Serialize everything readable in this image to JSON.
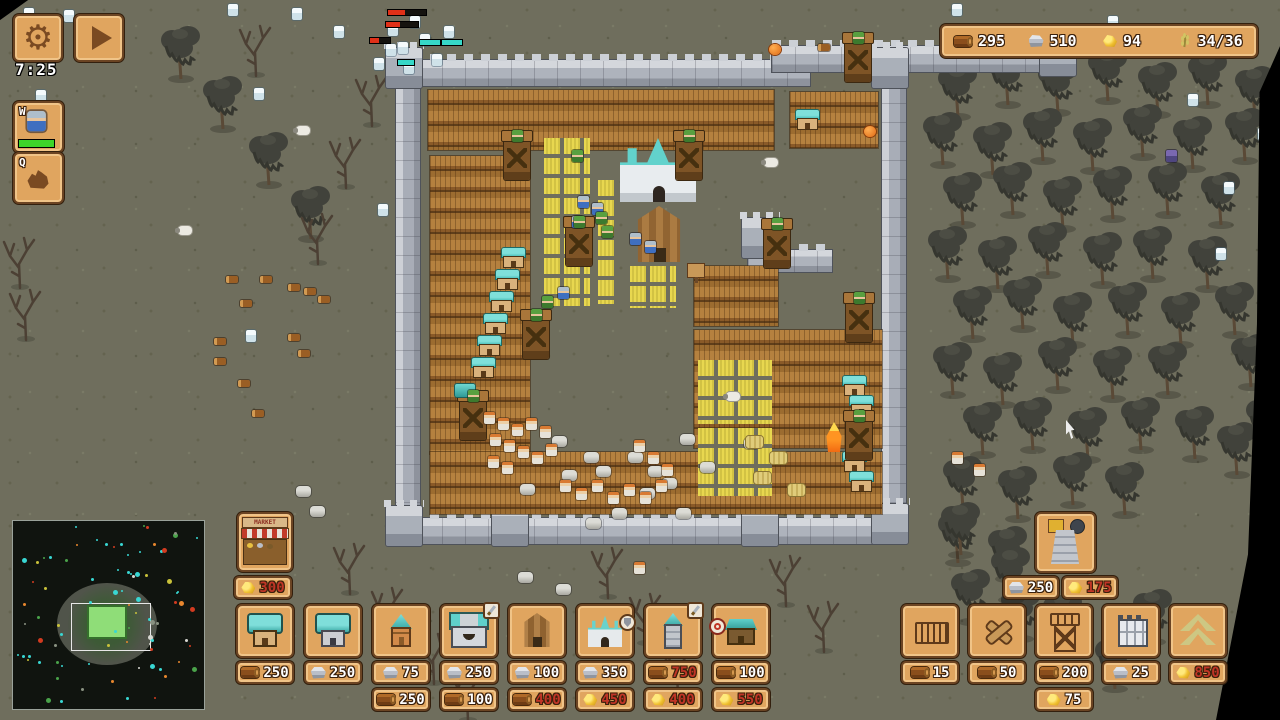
{
  "hud": {
    "timer": "7:25",
    "abilities": [
      {
        "key": "W"
      },
      {
        "key": "Q"
      }
    ],
    "resources": [
      {
        "name": "wood",
        "value": "295"
      },
      {
        "name": "stone",
        "value": "510"
      },
      {
        "name": "gold",
        "value": "94"
      },
      {
        "name": "food",
        "value": "34/36"
      }
    ],
    "colors": {
      "panel": "#e0a55f",
      "panel_border": "#6b4423",
      "cost_ok": "#ffffff",
      "cost_no": "#c03526",
      "hp_green": "#3ed52a",
      "hp_red": "#e03018",
      "hp_teal": "#36d8c8"
    }
  },
  "build": {
    "market": {
      "label": "MARKET",
      "costs": [
        {
          "res": "gold",
          "value": "300",
          "ok": false
        }
      ]
    },
    "tower_costs": [
      {
        "res": "stone",
        "value": "250",
        "ok": true
      },
      {
        "res": "gold",
        "value": "175",
        "ok": false
      }
    ],
    "left": [
      {
        "icon": "house-wood",
        "costs": [
          {
            "res": "wood",
            "value": "250",
            "ok": true
          }
        ]
      },
      {
        "icon": "house-stone",
        "costs": [
          {
            "res": "stone",
            "value": "250",
            "ok": true
          }
        ]
      },
      {
        "icon": "house-small",
        "costs": [
          {
            "res": "stone",
            "value": "75",
            "ok": true
          },
          {
            "res": "wood",
            "value": "250",
            "ok": true
          }
        ]
      },
      {
        "icon": "castle",
        "badge": "sword",
        "costs": [
          {
            "res": "stone",
            "value": "250",
            "ok": true
          },
          {
            "res": "wood",
            "value": "100",
            "ok": true
          }
        ]
      },
      {
        "icon": "barn",
        "costs": [
          {
            "res": "stone",
            "value": "100",
            "ok": true
          },
          {
            "res": "wood",
            "value": "400",
            "ok": false
          }
        ]
      },
      {
        "icon": "church",
        "badge": "shield",
        "costs": [
          {
            "res": "stone",
            "value": "350",
            "ok": true
          },
          {
            "res": "gold",
            "value": "450",
            "ok": false
          }
        ]
      },
      {
        "icon": "spire",
        "badge": "sword",
        "costs": [
          {
            "res": "wood",
            "value": "750",
            "ok": false
          },
          {
            "res": "gold",
            "value": "400",
            "ok": false
          }
        ]
      },
      {
        "icon": "hut",
        "badge": "target",
        "costs": [
          {
            "res": "wood",
            "value": "100",
            "ok": true
          },
          {
            "res": "gold",
            "value": "550",
            "ok": false
          }
        ]
      }
    ],
    "right": [
      {
        "icon": "fence",
        "costs": [
          {
            "res": "wood",
            "value": "15",
            "ok": true
          }
        ]
      },
      {
        "icon": "spikes",
        "costs": [
          {
            "res": "wood",
            "value": "50",
            "ok": true
          }
        ]
      },
      {
        "icon": "watchtower",
        "costs": [
          {
            "res": "wood",
            "value": "200",
            "ok": true
          },
          {
            "res": "gold",
            "value": "75",
            "ok": true
          }
        ]
      },
      {
        "icon": "wall",
        "costs": [
          {
            "res": "stone",
            "value": "25",
            "ok": true
          }
        ]
      },
      {
        "icon": "upgrade",
        "costs": [
          {
            "res": "gold",
            "value": "850",
            "ok": false
          }
        ]
      }
    ]
  },
  "scene": {
    "structures": [
      {
        "t": "wallh",
        "x": 396,
        "y": 60,
        "w": 414,
        "h": 26
      },
      {
        "t": "wallh",
        "x": 772,
        "y": 46,
        "w": 288,
        "h": 26
      },
      {
        "t": "wallv",
        "x": 396,
        "y": 60,
        "w": 24,
        "h": 462
      },
      {
        "t": "wallv",
        "x": 882,
        "y": 70,
        "w": 24,
        "h": 452
      },
      {
        "t": "wallh",
        "x": 396,
        "y": 518,
        "w": 510,
        "h": 26
      },
      {
        "t": "wallv",
        "x": 748,
        "y": 226,
        "w": 24,
        "h": 98
      },
      {
        "t": "wallh",
        "x": 748,
        "y": 250,
        "w": 84,
        "h": 22
      },
      {
        "t": "walltower",
        "x": 386,
        "y": 48
      },
      {
        "t": "walltower",
        "x": 872,
        "y": 48
      },
      {
        "t": "walltower",
        "x": 386,
        "y": 506
      },
      {
        "t": "walltower",
        "x": 872,
        "y": 504
      },
      {
        "t": "walltower",
        "x": 492,
        "y": 506
      },
      {
        "t": "walltower",
        "x": 742,
        "y": 506
      },
      {
        "t": "walltower",
        "x": 1040,
        "y": 36
      },
      {
        "t": "walltower",
        "x": 742,
        "y": 218
      },
      {
        "t": "fence",
        "x": 428,
        "y": 90,
        "w": 346,
        "h": 60
      },
      {
        "t": "fence",
        "x": 790,
        "y": 92,
        "w": 88,
        "h": 56
      },
      {
        "t": "fence",
        "x": 430,
        "y": 156,
        "w": 100,
        "h": 298
      },
      {
        "t": "fence",
        "x": 430,
        "y": 452,
        "w": 452,
        "h": 62
      },
      {
        "t": "fence",
        "x": 694,
        "y": 266,
        "w": 84,
        "h": 60
      },
      {
        "t": "fence",
        "x": 694,
        "y": 330,
        "w": 188,
        "h": 118
      },
      {
        "t": "farm",
        "x": 544,
        "y": 138,
        "w": 46,
        "h": 168
      },
      {
        "t": "farm",
        "x": 598,
        "y": 180,
        "w": 20,
        "h": 124
      },
      {
        "t": "farm",
        "x": 630,
        "y": 266,
        "w": 46,
        "h": 42
      },
      {
        "t": "farm",
        "x": 698,
        "y": 360,
        "w": 74,
        "h": 64
      },
      {
        "t": "farm",
        "x": 698,
        "y": 428,
        "w": 74,
        "h": 68
      },
      {
        "t": "church",
        "x": 620,
        "y": 138
      },
      {
        "t": "barn",
        "x": 628,
        "y": 206
      },
      {
        "t": "sign",
        "x": 688,
        "y": 264
      },
      {
        "t": "house",
        "x": 504,
        "y": 248
      },
      {
        "t": "house",
        "x": 498,
        "y": 270
      },
      {
        "t": "house",
        "x": 492,
        "y": 292
      },
      {
        "t": "house",
        "x": 486,
        "y": 314
      },
      {
        "t": "house",
        "x": 480,
        "y": 336
      },
      {
        "t": "house",
        "x": 474,
        "y": 358
      },
      {
        "t": "house",
        "x": 845,
        "y": 376
      },
      {
        "t": "house",
        "x": 852,
        "y": 396
      },
      {
        "t": "house",
        "x": 845,
        "y": 452
      },
      {
        "t": "house",
        "x": 852,
        "y": 472
      },
      {
        "t": "house",
        "x": 798,
        "y": 110
      },
      {
        "t": "wtower",
        "x": 504,
        "y": 134
      },
      {
        "t": "wtower",
        "x": 676,
        "y": 134
      },
      {
        "t": "wtower",
        "x": 845,
        "y": 36
      },
      {
        "t": "wtower",
        "x": 523,
        "y": 313
      },
      {
        "t": "wtower",
        "x": 566,
        "y": 220
      },
      {
        "t": "wtower",
        "x": 764,
        "y": 222
      },
      {
        "t": "wtower",
        "x": 846,
        "y": 296
      },
      {
        "t": "wtower",
        "x": 460,
        "y": 394
      },
      {
        "t": "wtower",
        "x": 846,
        "y": 414
      }
    ],
    "props": {
      "stone": [
        [
          552,
          436
        ],
        [
          584,
          452
        ],
        [
          596,
          466
        ],
        [
          520,
          484
        ],
        [
          640,
          488
        ],
        [
          662,
          478
        ],
        [
          680,
          434
        ],
        [
          700,
          462
        ],
        [
          744,
          438
        ],
        [
          612,
          508
        ],
        [
          676,
          508
        ],
        [
          562,
          470
        ],
        [
          628,
          452
        ],
        [
          648,
          466
        ],
        [
          586,
          518
        ],
        [
          518,
          572
        ],
        [
          556,
          584
        ],
        [
          296,
          486
        ],
        [
          310,
          506
        ],
        [
          240,
          546
        ]
      ],
      "log": [
        [
          226,
          276
        ],
        [
          260,
          276
        ],
        [
          288,
          284
        ],
        [
          304,
          288
        ],
        [
          318,
          296
        ],
        [
          240,
          300
        ],
        [
          214,
          338
        ],
        [
          288,
          334
        ],
        [
          298,
          350
        ],
        [
          214,
          358
        ],
        [
          238,
          380
        ],
        [
          252,
          410
        ],
        [
          1192,
          28
        ],
        [
          818,
          44
        ]
      ],
      "hay": [
        [
          746,
          436
        ],
        [
          770,
          452
        ],
        [
          754,
          472
        ],
        [
          788,
          484
        ]
      ],
      "flag": [
        [
          455,
          384
        ]
      ],
      "fire": [
        [
          824,
          422
        ]
      ]
    },
    "units": {
      "skeleton": [
        [
          24,
          8
        ],
        [
          64,
          10
        ],
        [
          228,
          4
        ],
        [
          292,
          8
        ],
        [
          334,
          26
        ],
        [
          14,
          128
        ],
        [
          36,
          90
        ],
        [
          254,
          88
        ],
        [
          952,
          4
        ],
        [
          374,
          58
        ],
        [
          388,
          24
        ],
        [
          398,
          42
        ],
        [
          410,
          16
        ],
        [
          420,
          34
        ],
        [
          432,
          54
        ],
        [
          444,
          26
        ],
        [
          404,
          62
        ],
        [
          386,
          44
        ],
        [
          378,
          204
        ],
        [
          246,
          330
        ],
        [
          1188,
          94
        ],
        [
          1224,
          182
        ],
        [
          1216,
          248
        ],
        [
          1258,
          128
        ],
        [
          1108,
          16
        ]
      ],
      "purple": [
        [
          1166,
          150
        ]
      ],
      "pumpkin": [
        [
          769,
          44
        ],
        [
          1058,
          24
        ],
        [
          864,
          126
        ]
      ],
      "sheep": [
        [
          178,
          226
        ],
        [
          296,
          126
        ],
        [
          764,
          158
        ],
        [
          726,
          392
        ]
      ],
      "soldier": [
        [
          578,
          196
        ],
        [
          592,
          203
        ],
        [
          572,
          216
        ],
        [
          630,
          233
        ],
        [
          645,
          241
        ],
        [
          558,
          287
        ]
      ],
      "archer": [
        [
          572,
          150
        ],
        [
          596,
          212
        ],
        [
          602,
          226
        ],
        [
          542,
          296
        ],
        [
          512,
          130
        ],
        [
          684,
          130
        ],
        [
          853,
          32
        ],
        [
          531,
          309
        ],
        [
          574,
          216
        ],
        [
          772,
          218
        ],
        [
          854,
          292
        ],
        [
          468,
          390
        ],
        [
          854,
          410
        ]
      ],
      "villager": [
        [
          484,
          412
        ],
        [
          498,
          418
        ],
        [
          512,
          424
        ],
        [
          526,
          418
        ],
        [
          540,
          426
        ],
        [
          490,
          434
        ],
        [
          504,
          440
        ],
        [
          518,
          446
        ],
        [
          532,
          452
        ],
        [
          546,
          444
        ],
        [
          488,
          456
        ],
        [
          502,
          462
        ],
        [
          560,
          480
        ],
        [
          576,
          488
        ],
        [
          592,
          480
        ],
        [
          608,
          492
        ],
        [
          624,
          484
        ],
        [
          640,
          492
        ],
        [
          656,
          480
        ],
        [
          634,
          440
        ],
        [
          648,
          452
        ],
        [
          662,
          464
        ],
        [
          952,
          452
        ],
        [
          974,
          464
        ],
        [
          634,
          562
        ]
      ]
    },
    "bars": {
      "red": [
        [
          388,
          10,
          38
        ],
        [
          386,
          22,
          32
        ],
        [
          370,
          38,
          20
        ]
      ],
      "teal": [
        [
          420,
          40,
          20
        ],
        [
          442,
          40,
          20
        ],
        [
          398,
          60,
          16
        ]
      ]
    },
    "trees": [
      [
        935,
        60,
        "w"
      ],
      [
        985,
        48,
        "w"
      ],
      [
        1035,
        56,
        "w"
      ],
      [
        1085,
        44,
        "w"
      ],
      [
        1135,
        58,
        "w"
      ],
      [
        1185,
        48,
        "w"
      ],
      [
        1232,
        62,
        "w"
      ],
      [
        920,
        108,
        "w"
      ],
      [
        970,
        118,
        "w"
      ],
      [
        1020,
        104,
        "w"
      ],
      [
        1070,
        114,
        "w"
      ],
      [
        1120,
        100,
        "w"
      ],
      [
        1170,
        112,
        "w"
      ],
      [
        1222,
        104,
        "w"
      ],
      [
        940,
        168,
        "w"
      ],
      [
        990,
        158,
        "w"
      ],
      [
        1040,
        172,
        "w"
      ],
      [
        1090,
        162,
        "w"
      ],
      [
        1145,
        158,
        "w"
      ],
      [
        1198,
        168,
        "w"
      ],
      [
        925,
        222,
        "w"
      ],
      [
        975,
        232,
        "w"
      ],
      [
        1025,
        218,
        "w"
      ],
      [
        1080,
        228,
        "w"
      ],
      [
        1130,
        222,
        "w"
      ],
      [
        1185,
        232,
        "w"
      ],
      [
        950,
        282,
        "w"
      ],
      [
        1000,
        272,
        "w"
      ],
      [
        1050,
        288,
        "w"
      ],
      [
        1105,
        278,
        "w"
      ],
      [
        1158,
        288,
        "w"
      ],
      [
        1212,
        278,
        "w"
      ],
      [
        930,
        338,
        "w"
      ],
      [
        980,
        348,
        "w"
      ],
      [
        1035,
        333,
        "w"
      ],
      [
        1090,
        342,
        "w"
      ],
      [
        1145,
        338,
        "w"
      ],
      [
        960,
        398,
        "w"
      ],
      [
        1010,
        393,
        "w"
      ],
      [
        1065,
        403,
        "w"
      ],
      [
        1118,
        393,
        "w"
      ],
      [
        1172,
        402,
        "w"
      ],
      [
        940,
        452,
        "w"
      ],
      [
        995,
        462,
        "w"
      ],
      [
        1050,
        448,
        "w"
      ],
      [
        1102,
        458,
        "w"
      ],
      [
        935,
        506,
        "w"
      ],
      [
        985,
        522,
        "w"
      ],
      [
        1038,
        512,
        "w"
      ],
      [
        948,
        565,
        "w"
      ],
      [
        998,
        582,
        "w"
      ],
      [
        1228,
        330,
        "w"
      ],
      [
        1243,
        392,
        "w"
      ],
      [
        1214,
        418,
        "w"
      ],
      [
        938,
        498,
        "w"
      ],
      [
        988,
        543,
        "w"
      ],
      [
        1040,
        588,
        "w"
      ],
      [
        1092,
        632,
        "w"
      ],
      [
        1130,
        585,
        "w"
      ],
      [
        158,
        22,
        "w"
      ],
      [
        200,
        72,
        "w"
      ],
      [
        246,
        128,
        "w"
      ],
      [
        288,
        182,
        "w"
      ],
      [
        236,
        20,
        "d"
      ],
      [
        326,
        132,
        "d"
      ],
      [
        298,
        208,
        "d"
      ],
      [
        352,
        70,
        "d"
      ],
      [
        0,
        232,
        "d"
      ],
      [
        6,
        284,
        "d"
      ],
      [
        330,
        538,
        "d"
      ],
      [
        368,
        582,
        "d"
      ],
      [
        414,
        628,
        "d"
      ],
      [
        448,
        665,
        "d"
      ],
      [
        588,
        542,
        "d"
      ],
      [
        626,
        588,
        "d"
      ],
      [
        658,
        640,
        "d"
      ],
      [
        766,
        550,
        "d"
      ],
      [
        804,
        596,
        "d"
      ],
      [
        58,
        588,
        "d"
      ],
      [
        100,
        634,
        "d"
      ]
    ]
  }
}
